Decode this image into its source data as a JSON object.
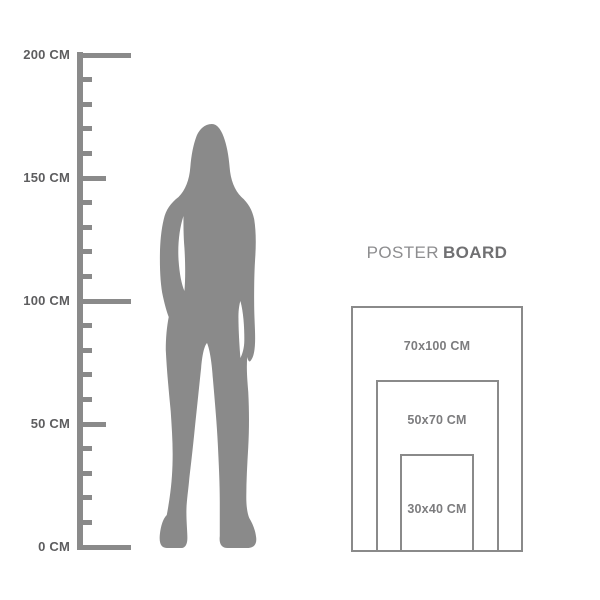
{
  "title": {
    "regular": "POSTER",
    "bold": "BOARD"
  },
  "ruler": {
    "unit": "CM",
    "min_cm": 0,
    "max_cm": 200,
    "minor_step_cm": 10,
    "medium_step_cm": 50,
    "major_step_cm": 100,
    "labels": [
      {
        "cm": 200,
        "text": "200 CM"
      },
      {
        "cm": 150,
        "text": "150 CM"
      },
      {
        "cm": 100,
        "text": "100 CM"
      },
      {
        "cm": 50,
        "text": "50 CM"
      },
      {
        "cm": 0,
        "text": "0 CM"
      }
    ]
  },
  "poster_board": {
    "sizes": [
      {
        "label": "70x100 CM",
        "width_cm": 70,
        "height_cm": 100
      },
      {
        "label": "50x70 CM",
        "width_cm": 50,
        "height_cm": 70
      },
      {
        "label": "30x40 CM",
        "width_cm": 30,
        "height_cm": 40
      }
    ]
  },
  "colors": {
    "background": "#ffffff",
    "ruler_gray": "#8a8a8a",
    "silhouette_gray": "#8a8a8a",
    "rect_border_gray": "#8a8a8a",
    "ruler_label_text": "#5d5d5f",
    "title_regular_text": "#8d8d8f",
    "title_bold_text": "#707072",
    "size_label_text": "#7c7c7e"
  }
}
